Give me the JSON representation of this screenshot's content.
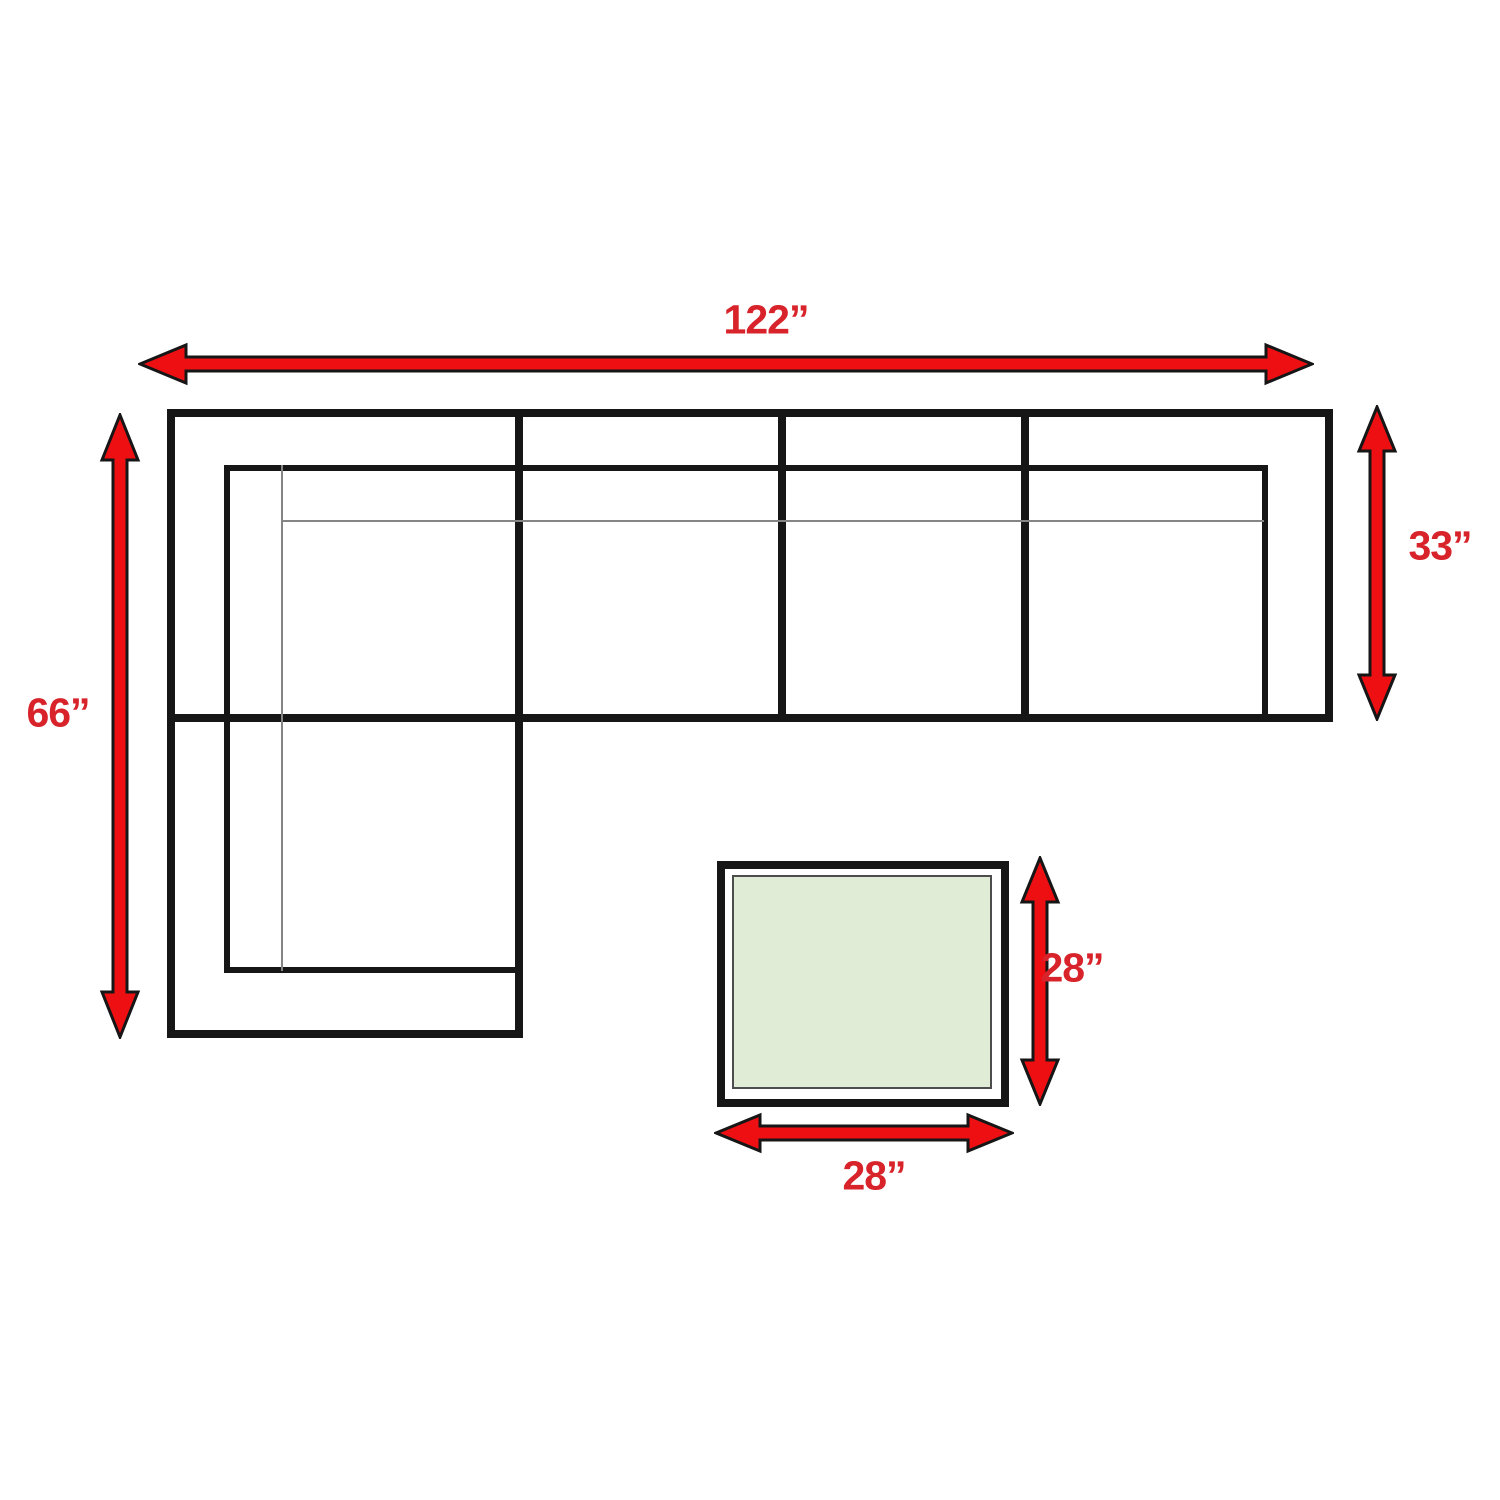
{
  "diagram": {
    "name": "Sectional sofa with ottoman dimension diagram",
    "labels": {
      "sofa_width": "122”",
      "chaise_depth": "66”",
      "sofa_depth": "33”",
      "ottoman_depth": "28”",
      "ottoman_width": "28”"
    },
    "colors": {
      "arrow_red": "#ee0f13",
      "label_red": "#d8232b",
      "line_black": "#161616",
      "thin_gray": "#858585",
      "table_green": "#e1ecd7",
      "table_inner_border": "#4d4d4d",
      "page_bg": "#ffffff"
    }
  }
}
